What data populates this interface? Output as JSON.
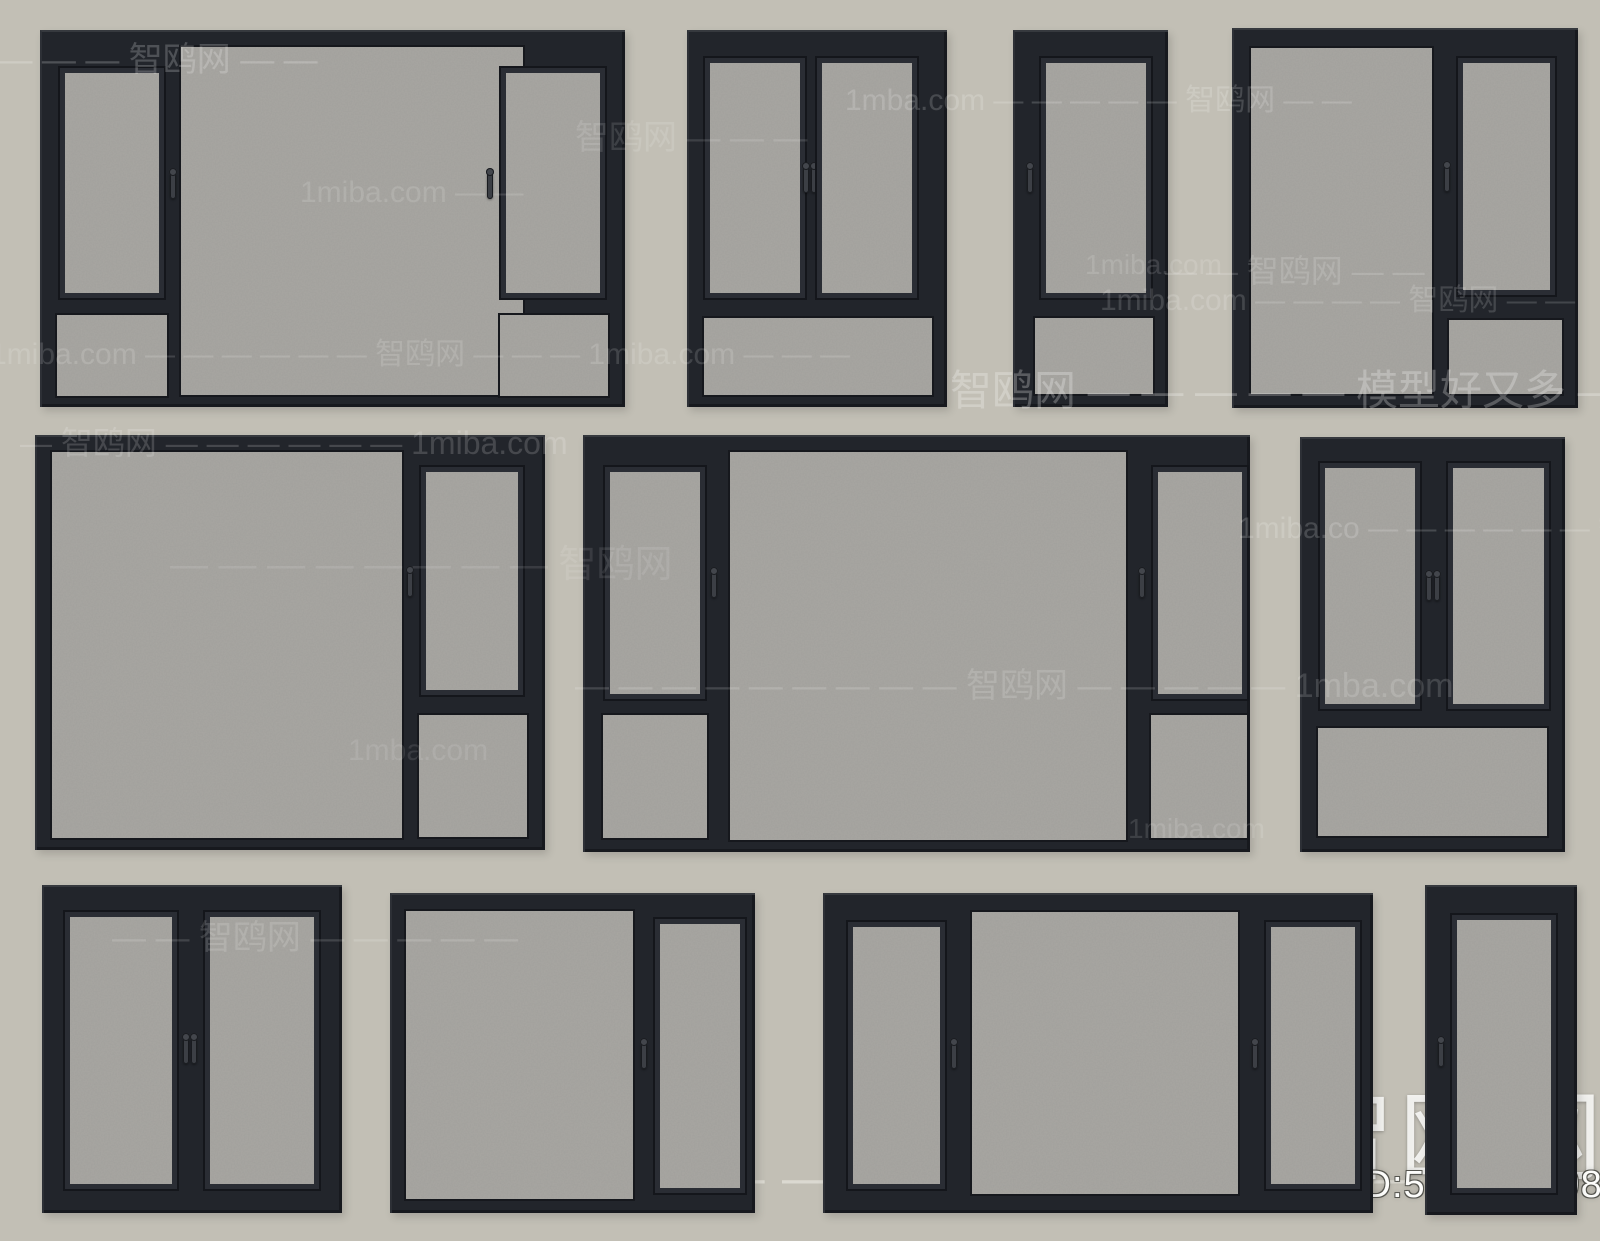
{
  "canvas": {
    "width": 1600,
    "height": 1241,
    "background": "#c2bfb5"
  },
  "colors": {
    "frame": "#22252b",
    "sash": "#2a2d34",
    "glass": "#a9a7a2",
    "watermark": "#ffffff"
  },
  "branding": {
    "site_name": "智鸥网",
    "model_id": "ID:549750098",
    "tagline": "智鸥网 — — — — — 模型好又多 — — — —",
    "logo_icon": "seagull-icon"
  },
  "watermarks": [
    {
      "text": "— — — — 智鸥网 — —",
      "x": -45,
      "y": 42,
      "size": 34,
      "op": 0.2
    },
    {
      "text": "1mba.com — — — — — 智鸥网 — —",
      "x": 845,
      "y": 84,
      "size": 30,
      "op": 0.17
    },
    {
      "text": "智鸥网 — — —",
      "x": 575,
      "y": 120,
      "size": 34,
      "op": 0.12
    },
    {
      "text": "1miba.com — —",
      "x": 300,
      "y": 176,
      "size": 30,
      "op": 0.13
    },
    {
      "text": "1miba.com",
      "x": 1085,
      "y": 250,
      "size": 28,
      "op": 0.13
    },
    {
      "text": "— — 智鸥网 — —",
      "x": 1165,
      "y": 254,
      "size": 32,
      "op": 0.15
    },
    {
      "text": "1miba.com — — — — 智鸥网 — —",
      "x": 1100,
      "y": 284,
      "size": 30,
      "op": 0.15
    },
    {
      "text": "1miba.com — — — — — — 智鸥网 — — — 1miba.com — — —",
      "x": -10,
      "y": 338,
      "size": 30,
      "op": 0.14
    },
    {
      "text": "智鸥网 — — — — — 模型好又多 — — —",
      "x": 950,
      "y": 368,
      "size": 42,
      "op": 0.25
    },
    {
      "text": "— 智鸥网 — — — — — — 1miba.com",
      "x": 20,
      "y": 426,
      "size": 32,
      "op": 0.16
    },
    {
      "text": "— — — — — — — — 智鸥网",
      "x": 170,
      "y": 545,
      "size": 38,
      "op": 0.1
    },
    {
      "text": "1miba.co — — — — — — 智鸥网 — —",
      "x": 1238,
      "y": 512,
      "size": 30,
      "op": 0.17
    },
    {
      "text": "— — — — — — — — — 智鸥网 — — — — — 1mba.com",
      "x": 575,
      "y": 668,
      "size": 34,
      "op": 0.15
    },
    {
      "text": "1mba.com",
      "x": 348,
      "y": 734,
      "size": 30,
      "op": 0.1
    },
    {
      "text": "1miba.com",
      "x": 1128,
      "y": 814,
      "size": 28,
      "op": 0.12
    },
    {
      "text": "— — 智鸥网 — — — — —",
      "x": 112,
      "y": 920,
      "size": 34,
      "op": 0.14
    }
  ],
  "windows": [
    {
      "name": "top-1",
      "x": 40,
      "y": 30,
      "w": 585,
      "h": 377,
      "panes": [
        {
          "x": 18,
          "y": 36,
          "w": 104,
          "h": 230,
          "sash": true,
          "handle": "right"
        },
        {
          "x": 13,
          "y": 281,
          "w": 114,
          "h": 85,
          "sash": false
        },
        {
          "x": 137,
          "y": 13,
          "w": 346,
          "h": 352,
          "sash": false
        },
        {
          "x": 459,
          "y": 36,
          "w": 104,
          "h": 230,
          "sash": true,
          "handle": "left"
        },
        {
          "x": 456,
          "y": 281,
          "w": 112,
          "h": 85,
          "sash": false
        }
      ]
    },
    {
      "name": "top-2",
      "x": 687,
      "y": 30,
      "w": 260,
      "h": 377,
      "panes": [
        {
          "x": 16,
          "y": 26,
          "w": 100,
          "h": 240,
          "sash": true,
          "handle": "right"
        },
        {
          "x": 128,
          "y": 26,
          "w": 100,
          "h": 240,
          "sash": true,
          "handle": "left"
        },
        {
          "x": 13,
          "y": 284,
          "w": 232,
          "h": 81,
          "sash": false
        }
      ]
    },
    {
      "name": "top-3",
      "x": 1013,
      "y": 30,
      "w": 155,
      "h": 377,
      "panes": [
        {
          "x": 26,
          "y": 26,
          "w": 110,
          "h": 240,
          "sash": true,
          "handle": "left"
        },
        {
          "x": 18,
          "y": 284,
          "w": 122,
          "h": 80,
          "sash": false
        }
      ]
    },
    {
      "name": "top-4",
      "x": 1232,
      "y": 28,
      "w": 346,
      "h": 380,
      "panes": [
        {
          "x": 15,
          "y": 16,
          "w": 185,
          "h": 350,
          "sash": false
        },
        {
          "x": 224,
          "y": 28,
          "w": 97,
          "h": 237,
          "sash": true,
          "handle": "left"
        },
        {
          "x": 213,
          "y": 288,
          "w": 117,
          "h": 78,
          "sash": false
        }
      ]
    },
    {
      "name": "mid-1",
      "x": 35,
      "y": 435,
      "w": 510,
      "h": 415,
      "panes": [
        {
          "x": 13,
          "y": 13,
          "w": 354,
          "h": 390,
          "sash": false
        },
        {
          "x": 384,
          "y": 30,
          "w": 102,
          "h": 228,
          "sash": true,
          "handle": "left"
        },
        {
          "x": 380,
          "y": 276,
          "w": 112,
          "h": 126,
          "sash": false
        }
      ]
    },
    {
      "name": "mid-2",
      "x": 583,
      "y": 435,
      "w": 667,
      "h": 417,
      "panes": [
        {
          "x": 20,
          "y": 30,
          "w": 100,
          "h": 232,
          "sash": true,
          "handle": "right"
        },
        {
          "x": 16,
          "y": 276,
          "w": 108,
          "h": 127,
          "sash": false
        },
        {
          "x": 143,
          "y": 13,
          "w": 400,
          "h": 392,
          "sash": false
        },
        {
          "x": 568,
          "y": 30,
          "w": 94,
          "h": 232,
          "sash": true,
          "handle": "left"
        },
        {
          "x": 564,
          "y": 276,
          "w": 100,
          "h": 127,
          "sash": false
        }
      ]
    },
    {
      "name": "mid-3",
      "x": 1300,
      "y": 437,
      "w": 265,
      "h": 415,
      "panes": [
        {
          "x": 18,
          "y": 24,
          "w": 100,
          "h": 246,
          "sash": true,
          "handle": "right"
        },
        {
          "x": 146,
          "y": 24,
          "w": 101,
          "h": 246,
          "sash": true,
          "handle": "left"
        },
        {
          "x": 14,
          "y": 287,
          "w": 233,
          "h": 112,
          "sash": false
        }
      ]
    },
    {
      "name": "bottom-1",
      "x": 42,
      "y": 885,
      "w": 300,
      "h": 328,
      "panes": [
        {
          "x": 21,
          "y": 25,
          "w": 112,
          "h": 277,
          "sash": true,
          "handle": "right"
        },
        {
          "x": 161,
          "y": 25,
          "w": 114,
          "h": 277,
          "sash": true,
          "handle": "left"
        }
      ]
    },
    {
      "name": "bottom-2",
      "x": 390,
      "y": 893,
      "w": 365,
      "h": 320,
      "panes": [
        {
          "x": 12,
          "y": 14,
          "w": 231,
          "h": 292,
          "sash": false
        },
        {
          "x": 263,
          "y": 24,
          "w": 90,
          "h": 274,
          "sash": true,
          "handle": "left"
        }
      ]
    },
    {
      "name": "bottom-3",
      "x": 823,
      "y": 893,
      "w": 550,
      "h": 320,
      "panes": [
        {
          "x": 23,
          "y": 27,
          "w": 97,
          "h": 267,
          "sash": true,
          "handle": "right"
        },
        {
          "x": 145,
          "y": 15,
          "w": 270,
          "h": 286,
          "sash": false
        },
        {
          "x": 441,
          "y": 27,
          "w": 94,
          "h": 267,
          "sash": true,
          "handle": "left"
        }
      ]
    },
    {
      "name": "bottom-4",
      "x": 1425,
      "y": 885,
      "w": 152,
      "h": 330,
      "panes": [
        {
          "x": 25,
          "y": 28,
          "w": 104,
          "h": 278,
          "sash": true,
          "handle": "left"
        }
      ]
    }
  ]
}
